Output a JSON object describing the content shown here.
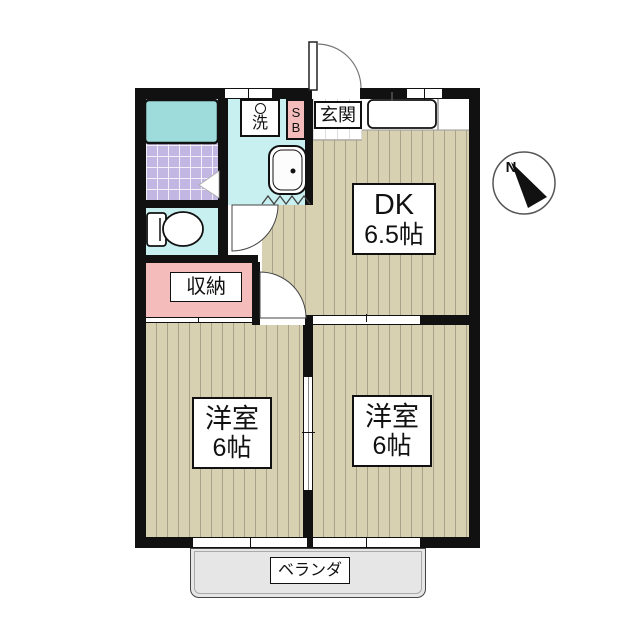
{
  "labels": {
    "dk_name": "DK",
    "dk_size": "6.5帖",
    "room_left_name": "洋室",
    "room_left_size": "6帖",
    "room_right_name": "洋室",
    "room_right_size": "6帖",
    "entrance": "玄関",
    "storage": "収納",
    "veranda": "ベランダ",
    "washer": "洗",
    "shoebox": "SB",
    "compass_north": "N"
  },
  "colors": {
    "wall": "#111111",
    "floor": "#d7d1b2",
    "floor-stripe": "#aaa389",
    "water": "#c9f0f0",
    "tub": "#9edcdc",
    "tile": "#c2b7e2",
    "pink": "#f5bcbc",
    "veranda-bg": "#e6e6e6"
  }
}
